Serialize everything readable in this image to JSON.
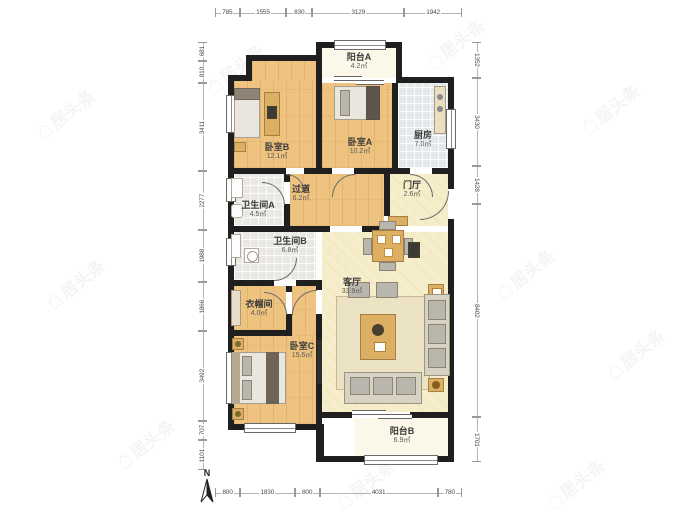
{
  "watermark": {
    "icon": "⌂",
    "text": "居头条"
  },
  "compass": {
    "label": "N"
  },
  "rooms": [
    {
      "name": "阳台A",
      "area": "4.2㎡"
    },
    {
      "name": "卧室B",
      "area": "12.1㎡"
    },
    {
      "name": "卧室A",
      "area": "10.2㎡"
    },
    {
      "name": "厨房",
      "area": "7.0㎡"
    },
    {
      "name": "过道",
      "area": "6.2㎡"
    },
    {
      "name": "门厅",
      "area": "2.6㎡"
    },
    {
      "name": "卫生间A",
      "area": "4.5㎡"
    },
    {
      "name": "卫生间B",
      "area": "6.8㎡"
    },
    {
      "name": "衣帽间",
      "area": "4.0㎡"
    },
    {
      "name": "客厅",
      "area": "33.9㎡"
    },
    {
      "name": "卧室C",
      "area": "15.6㎡"
    },
    {
      "name": "阳台B",
      "area": "6.9㎡"
    }
  ],
  "dimensions": {
    "top": [
      "785",
      "1555",
      "830",
      "3129",
      "1942"
    ],
    "bottom": [
      "800",
      "1830",
      "800",
      "4031",
      "780"
    ],
    "left": [
      "681",
      "810",
      "3411",
      "2277",
      "1988",
      "1866",
      "3492",
      "707",
      "1101"
    ],
    "right": [
      "1352",
      "3430",
      "1428",
      "8402",
      "1701"
    ]
  },
  "colors": {
    "wall": "#1f1f1f",
    "wood_floor": "#eec27f",
    "living_floor": "#f6edca",
    "tile_floor": "#e4eaec",
    "balcony_floor": "#fbf8ea"
  }
}
